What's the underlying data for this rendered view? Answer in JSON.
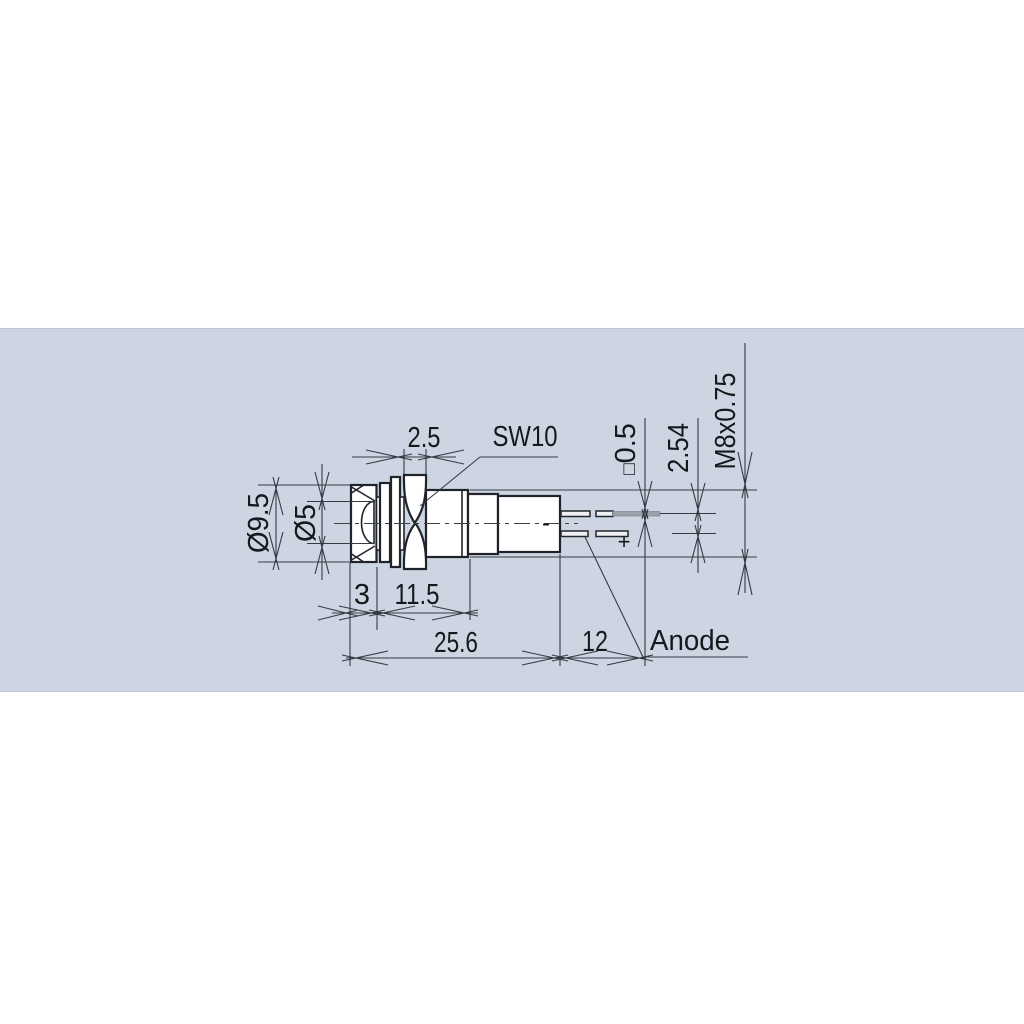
{
  "drawing": {
    "title_hint": "LED panel indicator dimension drawing",
    "dims": {
      "outer_dia": "Ø9.5",
      "led_dia": "Ø5",
      "nut_width": "2.5",
      "wrench_size": "SW10",
      "pin_square_symbol": "□",
      "pin_square": "0.5",
      "pin_pitch": "2.54",
      "thread_spec": "M8x0.75",
      "bezel_len": "3",
      "thread_len": "11.5",
      "body_len": "25.6",
      "pin_len": "12"
    },
    "labels": {
      "anode": "Anode",
      "anode_polarity": "+",
      "cathode_polarity": "-"
    },
    "colors": {
      "page_bg": "#ffffff",
      "panel_bg": "#cdd5e2",
      "panel_edge": "#bcc5d4",
      "line": "#20242a"
    }
  }
}
